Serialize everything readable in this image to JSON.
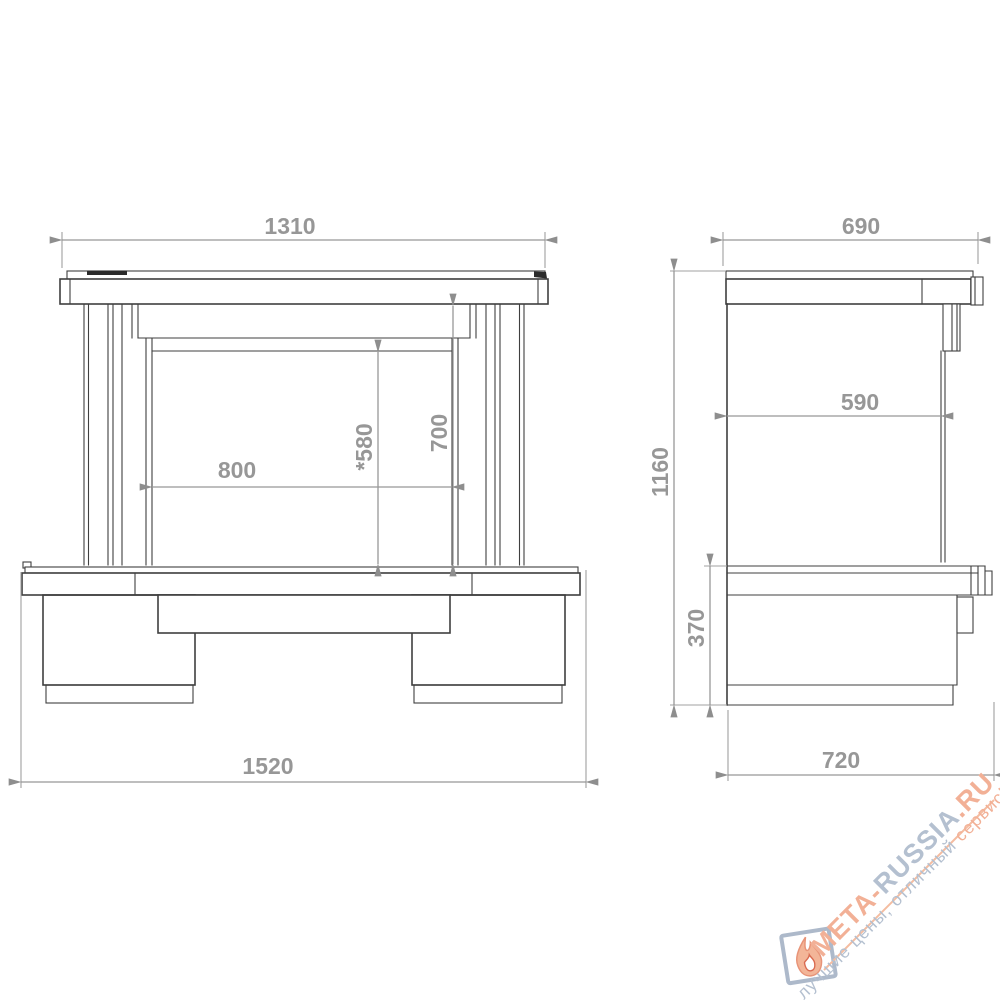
{
  "dims": {
    "front_top_width": "1310",
    "front_opening_width": "800",
    "front_opening_clear_height": "*580",
    "front_opening_height": "700",
    "front_base_width": "1520",
    "side_top_depth": "690",
    "side_inner_depth": "590",
    "side_total_height": "1160",
    "side_base_height": "370",
    "side_base_depth": "720"
  },
  "watermark": {
    "site_part1": "МЕТА-",
    "site_part2": "RUSSIA",
    "site_part3": ".RU",
    "tagline_part1": "лучшие цены, отличный ",
    "tagline_part2": "сервис!",
    "colors": {
      "accent": "#f2b096",
      "muted": "#b4c0d0"
    },
    "logo": "flame-icon"
  },
  "drawing": {
    "line_color": "#3f3f3f",
    "dimension_color": "#979797",
    "background": "#ffffff"
  }
}
